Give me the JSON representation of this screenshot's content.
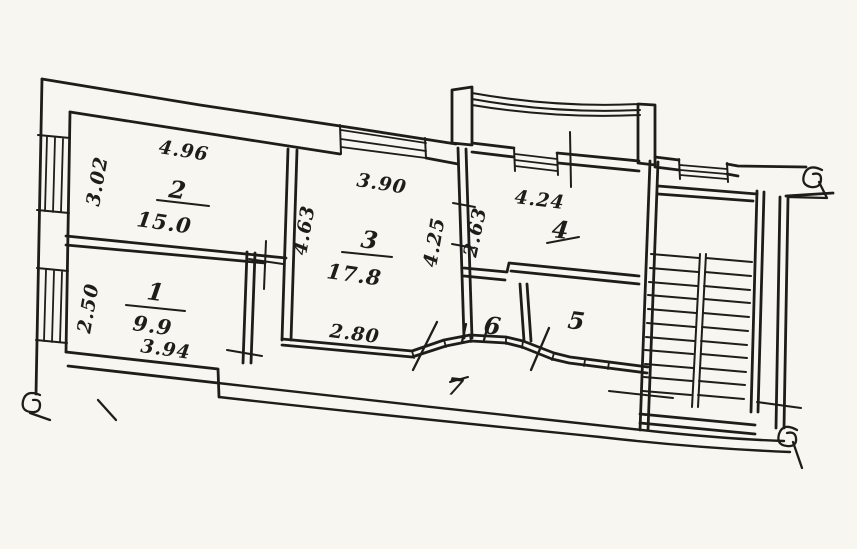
{
  "plan": {
    "kind": "scanned hand-drawn apartment floor plan",
    "ink_color": "#1f1d1a",
    "paper_color": "#f7f6f1",
    "rooms": {
      "r1": {
        "number": "1",
        "area": "9.9"
      },
      "r2": {
        "number": "2",
        "area": "15.0"
      },
      "r3": {
        "number": "3",
        "area": "17.8"
      },
      "r4": {
        "number": "4"
      },
      "r5": {
        "number": "5"
      },
      "r6": {
        "number": "6"
      },
      "r7": {
        "number": "7"
      }
    },
    "dimensions": {
      "room2_width_top": "4.96",
      "room2_height_left": "3.02",
      "room1_height_left": "2.50",
      "room1_width_bottom": "3.94",
      "room3_width_top": "3.90",
      "room3_height_left": "4.63",
      "room3_height_right": "4.25",
      "room3_width_bottom": "2.80",
      "room4_height_left": "2.63",
      "room4_width_top": "4.24"
    }
  }
}
